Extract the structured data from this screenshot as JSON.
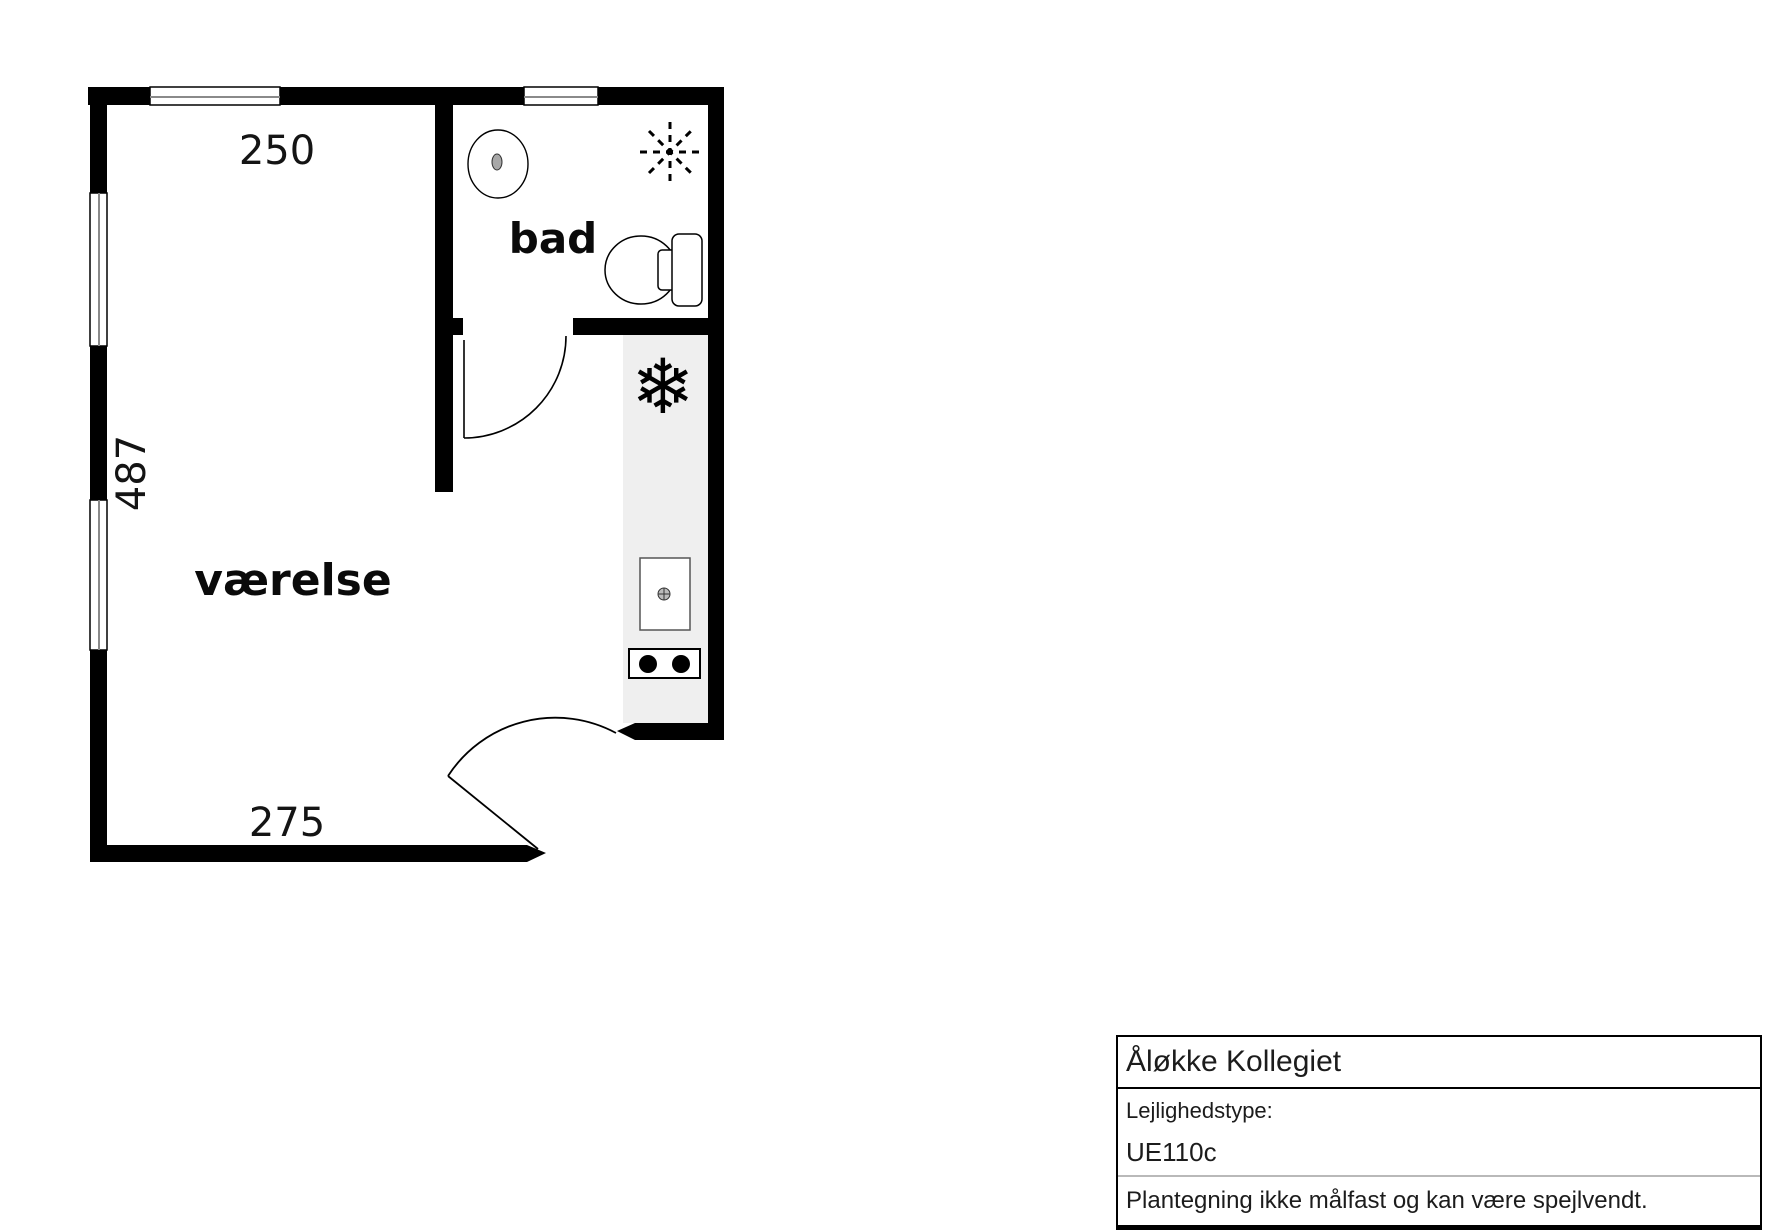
{
  "plan": {
    "room_label": "værelse",
    "bath_label": "bad",
    "dim_top": "250",
    "dim_left": "487",
    "dim_bottom": "275",
    "symbols": {
      "snowflake_glyph": "❄",
      "snowflake_meaning": "refrigerator-freezer",
      "fan_meaning": "ceiling-fan-ventilation",
      "bath_fixtures": [
        "washbasin",
        "toilet"
      ],
      "kitchen_fixtures": [
        "sink",
        "stove-two-burners"
      ]
    },
    "colors": {
      "wall": "#000000",
      "kitchen_floor": "#efefef",
      "window_glass_line": "#8a8a8a",
      "dimension_text": "#141414"
    }
  },
  "info_box": {
    "title": "Åløkke Kollegiet",
    "type_label": "Lejlighedstype:",
    "type_value": "UE110c",
    "disclaimer": "Plantegning ikke målfast og kan være spejlvendt."
  }
}
